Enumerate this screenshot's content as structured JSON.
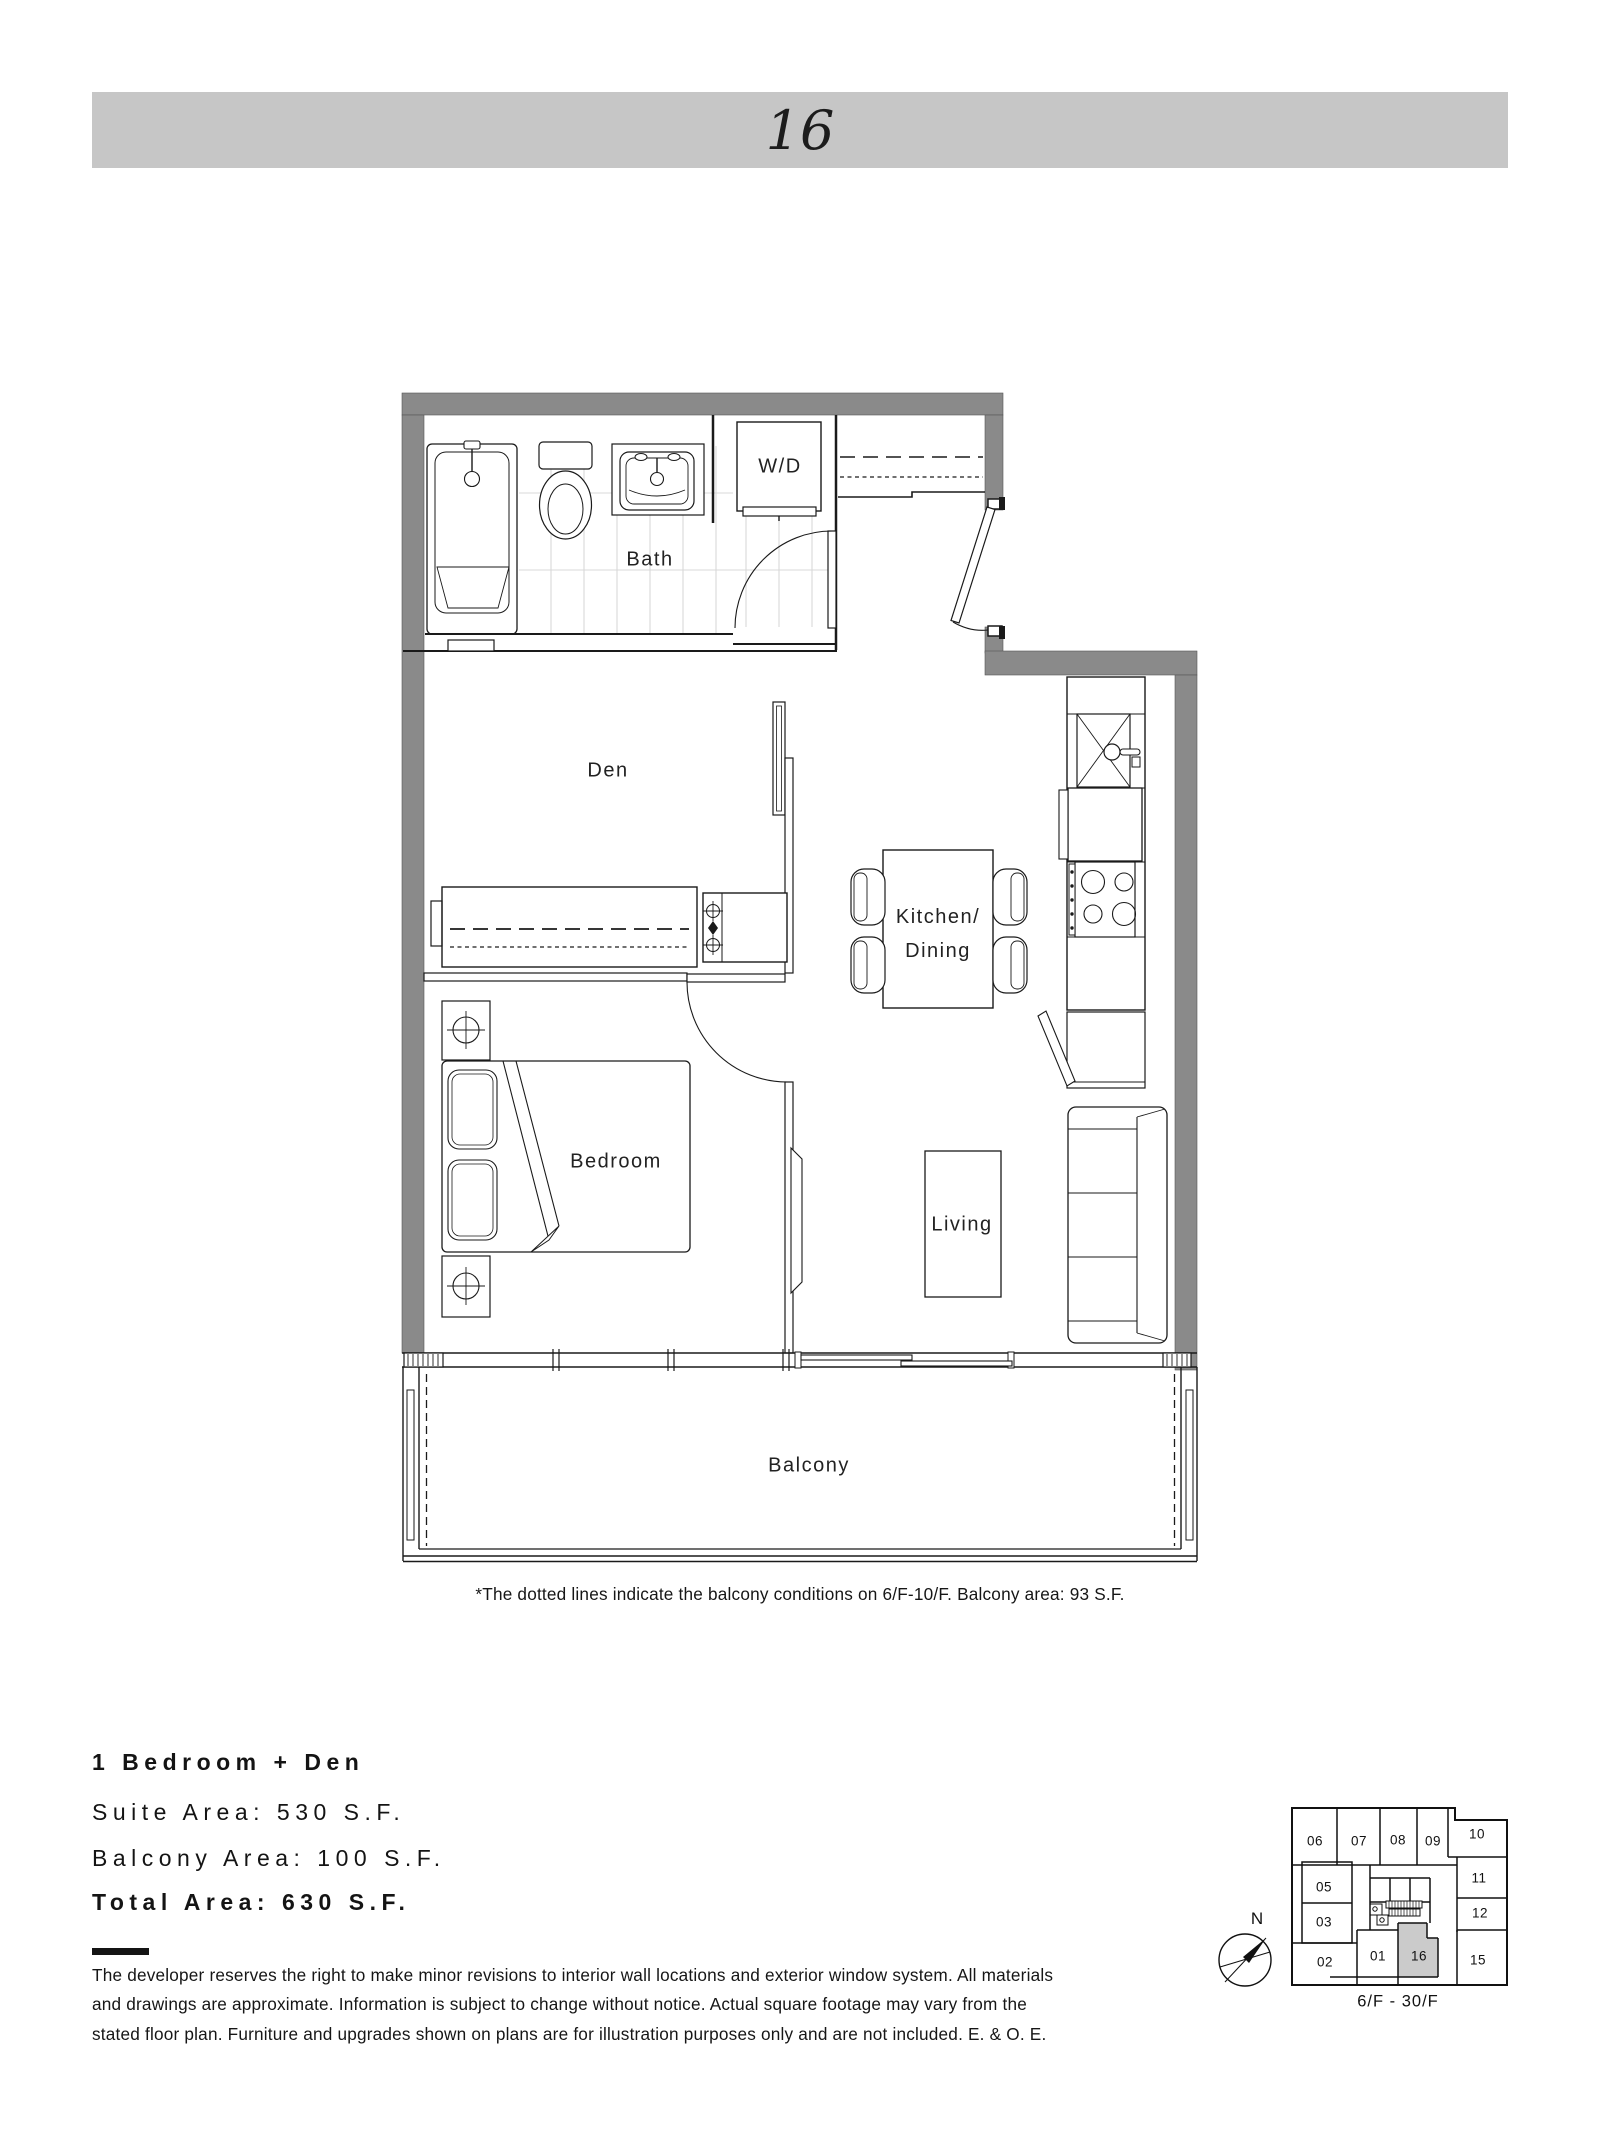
{
  "banner": {
    "unit_number": "16"
  },
  "plan": {
    "rooms": {
      "bath": "Bath",
      "wd": "W/D",
      "den": "Den",
      "kitchen_line1": "Kitchen/",
      "kitchen_line2": "Dining",
      "bedroom": "Bedroom",
      "living": "Living",
      "balcony": "Balcony"
    },
    "note": "*The dotted lines indicate the balcony conditions on 6/F-10/F. Balcony area: 93 S.F."
  },
  "summary": {
    "plan_type": "1 Bedroom + Den",
    "suite_area": "Suite Area: 530 S.F.",
    "balcony_area": "Balcony Area: 100 S.F.",
    "total_area": "Total Area: 630 S.F."
  },
  "disclaimer": "The developer reserves the right to make minor revisions to interior wall locations and exterior window system. All materials\nand drawings are approximate. Information is subject to change without notice. Actual square footage may vary from the\nstated floor plan. Furniture and upgrades shown on plans are for illustration purposes only and are not included. E. & O. E.",
  "keyplan": {
    "units": [
      "06",
      "07",
      "08",
      "09",
      "10",
      "05",
      "11",
      "03",
      "12",
      "02",
      "01",
      "16",
      "15"
    ],
    "highlighted_unit": "16",
    "floors_label": "6/F - 30/F",
    "compass_label": "N",
    "highlight_color": "#cbcbcb"
  },
  "colors": {
    "banner": "#c6c6c6",
    "wall": "#8a8a8a",
    "line": "#1a1a1a",
    "tile": "#d8d8d8"
  }
}
